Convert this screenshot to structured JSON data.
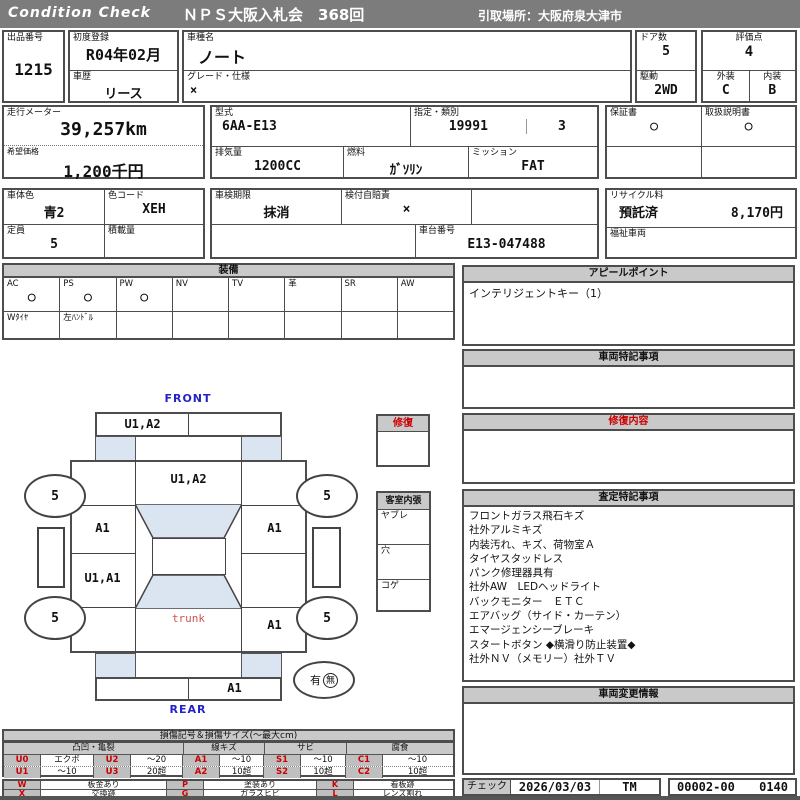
{
  "header": {
    "brand": "Condition  Check",
    "title": "ＮＰＳ大阪入札会　368回",
    "pickup": "引取場所：大阪府泉大津市"
  },
  "info": {
    "lot": {
      "label": "出品番号",
      "value": "1215"
    },
    "first_reg": {
      "label": "初度登録",
      "value": "R04年02月"
    },
    "history": {
      "label": "車歴",
      "value": "リース"
    },
    "model": {
      "label": "車種名",
      "value": "ノート"
    },
    "grade": {
      "label": "グレード・仕様",
      "value": "×"
    },
    "doors": {
      "label": "ドア数",
      "value": "5"
    },
    "drive": {
      "label": "駆動",
      "value": "2WD"
    },
    "score": {
      "label": "評価点",
      "value": "4"
    },
    "exterior": {
      "label": "外装",
      "value": "C"
    },
    "interior": {
      "label": "内装",
      "value": "B"
    },
    "odometer": {
      "label": "走行メーター",
      "value": "39,257km"
    },
    "price": {
      "label": "希望価格",
      "value": "1,200千円"
    },
    "model_code": {
      "label": "型式",
      "value": "6AA-E13"
    },
    "type_class": {
      "label": "指定・類別",
      "value1": "19991",
      "value2": "3"
    },
    "displacement": {
      "label": "排気量",
      "value": "1200CC"
    },
    "fuel": {
      "label": "燃料",
      "value": "ｶﾞｿﾘﾝ"
    },
    "mission": {
      "label": "ミッション",
      "value": "FAT"
    },
    "warranty": {
      "label": "保証書",
      "value": "○"
    },
    "manual": {
      "label": "取扱説明書",
      "value": "○"
    },
    "body_color": {
      "label": "車体色",
      "value": "青2"
    },
    "color_code": {
      "label": "色コード",
      "value": "XEH"
    },
    "inspection": {
      "label": "車検期限",
      "value": "抹消"
    },
    "jibaiseki": {
      "label": "検付自賠責",
      "value": "×"
    },
    "capacity": {
      "label": "定員",
      "value": "5"
    },
    "payload": {
      "label": "積載量",
      "value": ""
    },
    "chassis": {
      "label": "車台番号",
      "value": "E13-047488"
    },
    "recycle": {
      "label": "リサイクル料",
      "status": "預託済",
      "fee": "8,170円"
    },
    "welfare": {
      "label": "福祉車両",
      "value": ""
    }
  },
  "equipment": {
    "title": "装備",
    "cols": [
      {
        "label": "AC",
        "mark": "○"
      },
      {
        "label": "PS",
        "mark": "○"
      },
      {
        "label": "PW",
        "mark": "○"
      },
      {
        "label": "NV",
        "mark": ""
      },
      {
        "label": "TV",
        "mark": ""
      },
      {
        "label": "革",
        "mark": ""
      },
      {
        "label": "SR",
        "mark": ""
      },
      {
        "label": "AW",
        "mark": ""
      }
    ],
    "row2": [
      "Wﾀｲﾔ",
      "左ﾊﾝﾄﾞﾙ"
    ]
  },
  "sections": {
    "appeal": {
      "title": "アピールポイント",
      "content": "インテリジェントキー（1）"
    },
    "notes": {
      "title": "車両特記事項",
      "content": ""
    },
    "repair": {
      "title": "修復内容",
      "content": ""
    },
    "assessment": {
      "title": "査定特記事項",
      "lines": [
        "フロントガラス飛石キズ",
        "社外アルミキズ",
        "内装汚れ、キズ、荷物室Ａ",
        "タイヤスタッドレス",
        "パンク修理器具有",
        "社外AW　LEDヘッドライト",
        "バックモニター　ＥＴＣ",
        "エアバッグ（サイド・カーテン）",
        "エマージェンシーブレーキ",
        "スタートボタン ◆横滑り防止装置◆",
        "社外ＮＶ（メモリー）社外ＴＶ"
      ]
    },
    "changes": {
      "title": "車両変更情報",
      "content": ""
    }
  },
  "check": {
    "label": "チェック",
    "date": "2026/03/03",
    "inspector": "TM",
    "code": "00002-00",
    "number": "0140"
  },
  "diagram": {
    "front_label": "FRONT",
    "rear_label": "REAR",
    "front_bumper": "U1,A2",
    "hood": "U1,A2",
    "door_front_left": "A1",
    "door_front_right": "A1",
    "door_rear_left": "U1,A1",
    "fender_rear_right": "A1",
    "trunk": "trunk",
    "rear_bumper": "A1",
    "wheel_mark": "5",
    "presence": {
      "yes": "有",
      "no": "無"
    },
    "repair_box_title": "修復",
    "interior_box": {
      "title": "客室内張",
      "rows": [
        "ヤブレ",
        "穴",
        "コゲ"
      ]
    }
  },
  "legend": {
    "title": "損傷記号＆損傷サイズ(～最大cm)",
    "groups": [
      {
        "name": "凸凹・亀裂",
        "cells": [
          [
            "U0",
            "エクボ",
            "U2",
            "～20"
          ],
          [
            "U1",
            "～10",
            "U3",
            "20超"
          ]
        ]
      },
      {
        "name": "線キズ",
        "cells": [
          [
            "A1",
            "～10"
          ],
          [
            "A2",
            "10超"
          ]
        ]
      },
      {
        "name": "サビ",
        "cells": [
          [
            "S1",
            "～10"
          ],
          [
            "S2",
            "10超"
          ]
        ]
      },
      {
        "name": "腐食",
        "cells": [
          [
            "C1",
            "～10"
          ],
          [
            "C2",
            "10超"
          ]
        ]
      }
    ],
    "extra": [
      [
        "W",
        "板金あり",
        "P",
        "塗装あり",
        "K",
        "看板跡"
      ],
      [
        "X",
        "交換跡",
        "G",
        "ガラスヒビ",
        "L",
        "レンズ割れ"
      ]
    ]
  }
}
